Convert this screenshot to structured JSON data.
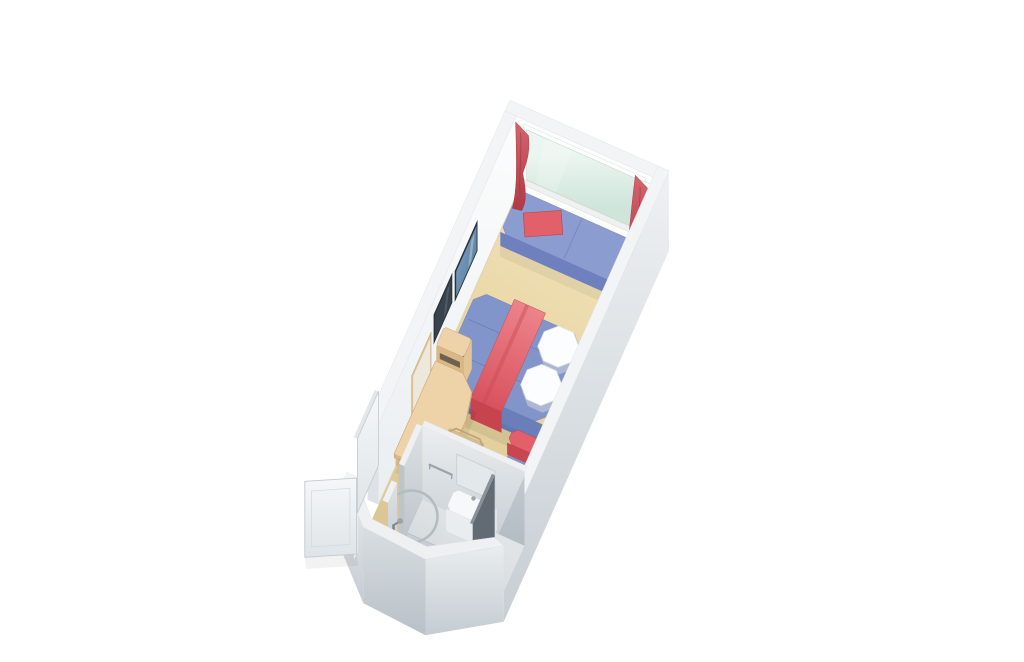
{
  "canvas": {
    "width": 1024,
    "height": 662,
    "background": "#ffffff"
  },
  "scene": {
    "id": "cruise-stateroom-cutaway-floorplan",
    "style": "3d-isometric-architectural-render",
    "rotation_deg": 24,
    "wall_height": 80
  },
  "objects": [
    "carpet-floor",
    "window-wall",
    "picture-window",
    "window-sill",
    "curtain-rod-bracket-left",
    "curtain-rod-bracket-right",
    "window-seat",
    "window-seat-pillow",
    "curtain-left",
    "curtain-right",
    "left-wall",
    "wall-art-picture",
    "wall-tv",
    "wall-mirror",
    "bed",
    "bed-runner",
    "bed-pillow-upper",
    "bed-pillow-lower",
    "nightstand-upper",
    "nightstand-lower",
    "cabinet-safe",
    "desk",
    "desk-drawer-unit",
    "desk-chair",
    "sofa",
    "sofa-bolster-upper",
    "sofa-bolster-lower",
    "right-wall",
    "bathroom-north-wall",
    "bathroom-partition",
    "bathroom-floor",
    "shower-floor",
    "shower-rod",
    "shower-column",
    "towel-bar",
    "vanity-counter",
    "vanity-mirror",
    "bathroom-door-panel",
    "toilet",
    "toilet-tank",
    "bathroom-pod-walls",
    "entry-door-leaf",
    "entry-door-leaf-2"
  ],
  "colors": {
    "background": "#ffffff",
    "carpet_1": "#f0e1b6",
    "carpet_2": "#e8d4a2",
    "carpet_3": "#d8c290",
    "wall_white": "#fcfdfd",
    "wall_top": "#f2f4f5",
    "wall_end": "#dde2e6",
    "wall_outer_1": "#eef1f3",
    "wall_outer_2": "#c7ced4",
    "glass_1": "#ecf6f0",
    "glass_2": "#cfe5da",
    "glass_frame": "#dfe4e2",
    "curtain_1": "#d5646d",
    "curtain_2": "#ae3a45",
    "curtain_fold": "#983038",
    "seat_top": "#8b9cd1",
    "seat_front": "#6e80bd",
    "seat_side": "#7b8cc5",
    "blue_seam": "#6f81be",
    "bed_top": "#8295ca",
    "bed_front": "#6a7eba",
    "bed_side": "#7386c1",
    "bed_seam": "#5f73b0",
    "runner_1": "#ee868e",
    "runner_2": "#d8515d",
    "runner_front": "#c7434e",
    "pillow_white": "#fcfdfe",
    "pillow_shade": "#c9cfd7",
    "red_cushion_top": "#e2606a",
    "red_cushion_front": "#c9454f",
    "sofa_top": "#8093c8",
    "sofa_front": "#6a7db9",
    "sofa_back": "#7285bf",
    "wood_top": "#eed3a9",
    "wood_front": "#d9b886",
    "wood_side": "#e3c497",
    "wood_edge": "#c7a678",
    "wood_slat": "#d5bd8f",
    "wood_leg": "#a98f66",
    "safe_slot": "#5c5146",
    "frame_dark": "#2b333c",
    "tv_screen": "#39434d",
    "art_1": "#86a8c8",
    "art_2": "#4d7496",
    "mirror_frame": "#dcc094",
    "mirror_glass": "#ece8db",
    "bath_top": "#eef0f2",
    "bath_wall_n1": "#ebeef0",
    "bath_wall_n2": "#c6cdd3",
    "bath_wall_l1": "#dde1e4",
    "bath_wall_l2": "#bdc4ca",
    "bath_inner_r1": "#c2cad0",
    "bath_inner_r2": "#a6aeb6",
    "bath_floor_1": "#e0e4e6",
    "bath_floor_2": "#c9cfd4",
    "shower_floor": "#c7cdd2",
    "pod_out_1": "#e9edef",
    "pod_out_2": "#c5ccd2",
    "pod_out_3": "#d8dee1",
    "pod_out_4": "#b9c0c7",
    "porcelain": "#f6f8f9",
    "porcelain_shade": "#e2e7ea",
    "chrome": "#9aa4ac",
    "chrome_dark": "#7e8892",
    "door_1": "#f5f7f8",
    "door_2": "#dfe4e8",
    "door_edge": "#c3cad0",
    "dark_panel": "#626b73",
    "dark_panel_edge": "#8a9299"
  }
}
